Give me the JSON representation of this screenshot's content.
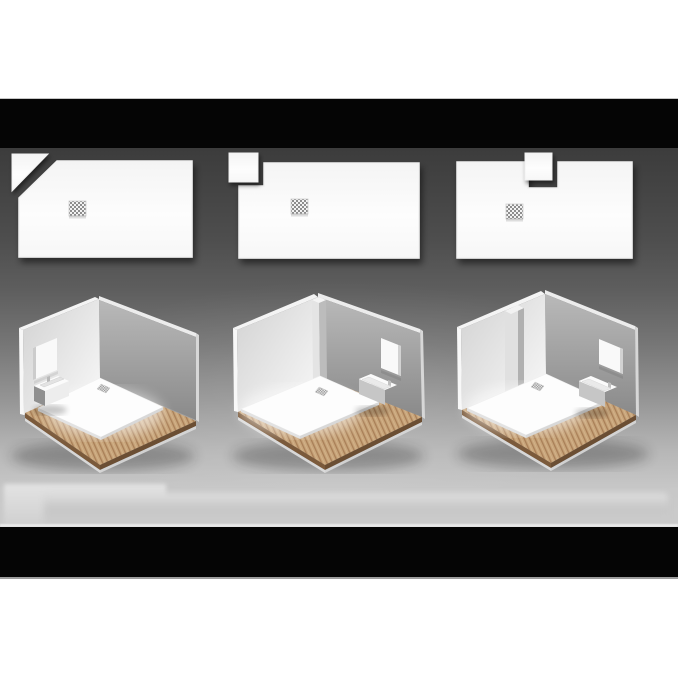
{
  "meta": {
    "visible_text": "none",
    "scene": "product-visual-three-cut-shower-tray-options"
  },
  "palette": {
    "page_background": "#ffffff",
    "letterbox_black": "#050505",
    "stage_gradient_top": "#3c3c3c",
    "stage_gradient_bottom": "#cbcbcb",
    "tray_white": "#fbfbfb",
    "tray_edge": "#f2f2f2",
    "drain_grid_dark": "#8d8d8d",
    "drain_grid_light": "#f2f2f2",
    "left_wall_shade": "#d2d2d2",
    "left_wall_light": "#f3f3f3",
    "right_wall_top": "#b9b9b9",
    "right_wall_bottom": "#8a8a8a",
    "wall_edge_white": "#f4f4f4",
    "wood_base": "#c7a47a",
    "wood_stripe": "#a97f57",
    "wood_stripe_light": "#d4b48a",
    "wood_edge_dark": "#74553a",
    "wood_rim_light": "#e0e0e0",
    "fixture_gray": "#c6c6c6",
    "basin_side_dark": "#8f8f8f"
  },
  "options": [
    {
      "id": "option-1",
      "tray_cut": "diagonal-corner-cut",
      "cut_piece_shape": "triangle",
      "drain": "square-grid-drain",
      "room": {
        "fixture_wall": "left",
        "fixtures": [
          "mirror",
          "wall-hung-basin"
        ],
        "column": "none",
        "floor": "wood-planks",
        "tray_position": "back-corner"
      }
    },
    {
      "id": "option-2",
      "tray_cut": "square-corner-notch",
      "cut_piece_shape": "square",
      "drain": "square-grid-drain",
      "room": {
        "fixture_wall": "right",
        "fixtures": [
          "mirror",
          "wall-hung-basin"
        ],
        "column": "corner-pillar",
        "floor": "wood-planks",
        "tray_position": "back-left"
      }
    },
    {
      "id": "option-3",
      "tray_cut": "square-edge-notch",
      "cut_piece_shape": "square",
      "drain": "square-grid-drain",
      "room": {
        "fixture_wall": "right",
        "fixtures": [
          "mirror",
          "wall-hung-basin"
        ],
        "column": "left-wall-pillar",
        "floor": "wood-planks",
        "tray_position": "back-left"
      }
    }
  ]
}
